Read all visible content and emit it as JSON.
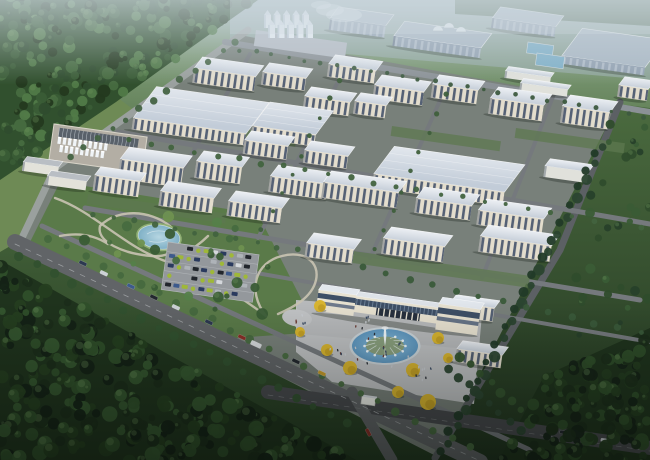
{
  "scene": {
    "kind": "aerial-architectural-rendering",
    "subject": "industrial-park-campus"
  },
  "palette": {
    "ground_top": "#a9bcbc",
    "ground_hi": "#7e9a78",
    "ground_mid": "#557548",
    "ground_low": "#3a5632",
    "ground_bot": "#243a22",
    "distant_pad": "#9fb0b6",
    "distant_roof": "#aab8c4",
    "distant_wall": "#93a2b2",
    "distant_trees": "#4e6850",
    "roof_hi": "#eef1f5",
    "roof_lo": "#c9d1db",
    "roofw_hi": "#e3e8ee",
    "roofw_lo": "#c2ccd8",
    "wall": "#e3ddcd",
    "shed_wall": "#e0e1db",
    "gray_roof": "#b9bec4",
    "gray_wall": "#e3e2da",
    "window_dark": "#46536c",
    "window_light": "#b9c4cf",
    "glass_band": "#3e4f66",
    "portal_dark": "#27303e",
    "gate_wall": "#e8e2d1",
    "campus_ground": "#78807a",
    "park_green": "#5a7a49",
    "meadow": "#6e8a55",
    "lawn_strip": "#5d7850",
    "road_light": "#9aa09e",
    "road_mid": "#75797d",
    "road_main": "#616467",
    "road_dark": "#47494d",
    "path": "#c9c3b2",
    "plaza": "#bfc1c3",
    "plaza_shade": "#b2b4b6",
    "pad_parking": "#94989c",
    "pond_hi": "#b6d6e2",
    "pond_lo": "#7fb0c6",
    "fountain_hi": "#8cc0de",
    "fountain_lo": "#5e97c0",
    "fountain_rim": "#ccd5da",
    "fountain_mound": "#8aa07e",
    "pool_blue": "#7fb0c8",
    "silo_body": "#eaf0f5",
    "silo_cone": "#dfe7ee",
    "silo_shade": "#9fb0bf",
    "tank_pad": "#b3aea4",
    "tank_frame": "#59616a",
    "tree_yellow": "#d9b52f",
    "tree_yellow_dk": "#b8941f",
    "haze": "#cfdae2"
  },
  "terrain": [
    {
      "d": "M0,0 H650 V460 H0 Z",
      "grad": "groundG"
    },
    {
      "d": "M230,0 H650 V80 L230,44 Z",
      "c": "#9fb0b6",
      "o": 0.55
    },
    {
      "d": "M455,0 H650 V26 L455,14 Z",
      "c": "#4e6850",
      "o": 0.9
    },
    {
      "d": "M0,176 L118,98 L158,128 L60,188 L24,238 L0,252 Z",
      "c": "#6e8a55",
      "o": 1
    },
    {
      "d": "M245,36 L618,104 L560,250 L436,456 L20,244 L55,168 Z",
      "c": "#78807a",
      "o": 1
    },
    {
      "d": "M618,104 L650,108 L650,460 L436,460 Z",
      "grad": "lawnG"
    },
    {
      "d": "M60,182 L258,214 L318,332 L236,338 L28,246 Z",
      "c": "#5a7a49",
      "o": 1
    },
    {
      "d": "M0,0 L258,0 L196,44 L116,102 L0,180 Z",
      "c": "#31502e",
      "o": 1
    },
    {
      "d": "M0,260 L360,462 L0,462 Z",
      "c": "#1f331d",
      "o": 1
    },
    {
      "d": "M544,376 L650,328 L650,462 L498,462 Z",
      "c": "#1f331d",
      "o": 1
    },
    {
      "d": "M296,300 L482,314 L474,404 L332,382 L296,352 Z",
      "c": "#bfc1c3",
      "o": 1
    },
    {
      "d": "M296,300 L482,314 L478,350 L300,334 Z",
      "c": "#b2b4b6",
      "o": 0.55
    }
  ],
  "roads": [
    {
      "d": "M248,30 L55,168 L20,242",
      "w": 7,
      "c": "#9aa09e"
    },
    {
      "d": "M225,42 L650,112",
      "w": 6,
      "c": "#8b9196"
    },
    {
      "d": "M620,102 L560,250 L435,458",
      "w": 7,
      "c": "#5c6064"
    },
    {
      "d": "M15,242 L480,462",
      "w": 16,
      "c": "#616467"
    },
    {
      "d": "M42,226 L530,450",
      "w": 5,
      "c": "#75797d"
    },
    {
      "d": "M118,132 L650,224",
      "w": 5,
      "c": "#75797d"
    },
    {
      "d": "M85,208 L640,300",
      "w": 5,
      "c": "#75797d"
    },
    {
      "d": "M228,268 L650,342",
      "w": 4,
      "c": "#75797d"
    },
    {
      "d": "M162,205 L250,54",
      "w": 4,
      "c": "#75797d"
    },
    {
      "d": "M258,238 L346,66",
      "w": 4,
      "c": "#75797d"
    },
    {
      "d": "M370,258 L450,78",
      "w": 4,
      "c": "#75797d"
    },
    {
      "d": "M482,278 L554,94",
      "w": 4,
      "c": "#75797d"
    },
    {
      "d": "M268,392 L650,448",
      "w": 14,
      "c": "#47494d"
    },
    {
      "d": "M352,392 L392,460",
      "w": 11,
      "c": "#606366"
    },
    {
      "d": "M15,244 L478,460",
      "w": 0.8,
      "c": "#9b9ea1",
      "dash": "5,7"
    },
    {
      "d": "M268,395 L650,451",
      "w": 0.7,
      "c": "#707376",
      "dash": "5,6"
    }
  ],
  "lawn_strips": [
    [
      148,
      116,
      150,
      10
    ],
    [
      88,
      194,
      140,
      10
    ],
    [
      332,
      248,
      200,
      12
    ],
    [
      516,
      128,
      110,
      10
    ],
    [
      392,
      126,
      110,
      10
    ]
  ],
  "park_paths": [
    "M55,198 C95,212 125,248 168,262 C205,274 240,296 266,316",
    "M100,226 C118,208 150,210 170,226 C188,240 176,258 152,256 C124,254 96,242 100,226",
    "M266,316 C246,290 256,262 282,256 C304,250 320,262 316,280 C312,298 292,308 278,314",
    "M168,262 C186,254 198,246 208,236",
    "M60,236 C80,232 96,236 108,244"
  ],
  "pond": {
    "cx": 159,
    "cy": 237,
    "rx": 21,
    "ry": 12,
    "rot": 8
  },
  "west_plaza": {
    "cx": 297,
    "cy": 318,
    "rx": 15,
    "ry": 8.5,
    "rot": 8
  },
  "parking": {
    "x": 168,
    "y": 242,
    "w": 92,
    "h": 48,
    "rot": 8,
    "rows": 5,
    "cols": 10,
    "car_colors": [
      "#2a3a5e",
      "#d4d7db",
      "#22262c",
      "#3d5a8c",
      "#9fb838",
      "#d4d7db",
      "#2a3a5e",
      "#9fb838",
      "#aeb3b8",
      "#22262c"
    ]
  },
  "distant_buildings": [
    [
      332,
      6,
      56,
      12,
      12,
      "d"
    ],
    [
      396,
      20,
      88,
      16,
      10,
      "d"
    ],
    [
      494,
      6,
      64,
      12,
      10,
      "d"
    ],
    [
      566,
      26,
      84,
      30,
      8,
      "d"
    ]
  ],
  "pools": [
    [
      528,
      42,
      26,
      11
    ],
    [
      537,
      53,
      28,
      12
    ]
  ],
  "silos": {
    "pad": [
      256,
      30,
      92,
      16
    ],
    "rows": [
      [
        264,
        10,
        5,
        9.5
      ],
      [
        268,
        20,
        5,
        9.5
      ]
    ]
  },
  "domes": [
    [
      438,
      31
    ],
    [
      449,
      28
    ],
    [
      461,
      32
    ]
  ],
  "steam": [
    [
      330,
      10,
      14,
      6
    ],
    [
      344,
      15,
      18,
      7
    ],
    [
      321,
      5,
      10,
      4
    ]
  ],
  "tank_farm": {
    "pad": [
      54,
      124,
      94,
      36
    ],
    "frame": [
      60,
      127,
      80,
      9
    ],
    "rows": [
      [
        60,
        136,
        10,
        5.2
      ],
      [
        63,
        144,
        9,
        5.2
      ]
    ],
    "sheds": [
      [
        24,
        156,
        36,
        6,
        9,
        "g"
      ],
      [
        48,
        170,
        40,
        6,
        9,
        "g"
      ]
    ]
  },
  "campus_buildings": [
    [
      196,
      56,
      62,
      12,
      15,
      "f"
    ],
    [
      264,
      62,
      44,
      10,
      13,
      "f"
    ],
    [
      330,
      54,
      48,
      10,
      13,
      "f"
    ],
    [
      376,
      74,
      50,
      11,
      14,
      "f"
    ],
    [
      434,
      74,
      46,
      10,
      14,
      "f"
    ],
    [
      492,
      86,
      54,
      12,
      16,
      "f"
    ],
    [
      564,
      94,
      48,
      12,
      17,
      "f"
    ],
    [
      620,
      76,
      30,
      9,
      12,
      "f"
    ],
    [
      506,
      66,
      46,
      5,
      7,
      "s"
    ],
    [
      521,
      78,
      48,
      5,
      7,
      "s"
    ],
    [
      138,
      84,
      114,
      34,
      12,
      "w"
    ],
    [
      256,
      100,
      64,
      26,
      12,
      "w"
    ],
    [
      306,
      86,
      46,
      10,
      14,
      "f"
    ],
    [
      356,
      92,
      32,
      9,
      13,
      "f"
    ],
    [
      378,
      144,
      132,
      30,
      14,
      "w"
    ],
    [
      546,
      158,
      44,
      8,
      11,
      "s"
    ],
    [
      96,
      166,
      46,
      9,
      16,
      "f"
    ],
    [
      122,
      146,
      64,
      13,
      20,
      "f"
    ],
    [
      198,
      150,
      46,
      11,
      17,
      "f"
    ],
    [
      246,
      130,
      44,
      10,
      14,
      "f"
    ],
    [
      272,
      164,
      58,
      12,
      16,
      "f"
    ],
    [
      306,
      140,
      44,
      10,
      13,
      "f"
    ],
    [
      325,
      170,
      76,
      12,
      16,
      "f"
    ],
    [
      418,
      186,
      56,
      12,
      15,
      "f"
    ],
    [
      480,
      198,
      66,
      12,
      15,
      "f"
    ],
    [
      162,
      180,
      54,
      11,
      15,
      "f"
    ],
    [
      230,
      190,
      54,
      11,
      15,
      "f"
    ],
    [
      308,
      232,
      48,
      11,
      14,
      "f"
    ],
    [
      385,
      226,
      62,
      12,
      16,
      "f"
    ],
    [
      482,
      224,
      72,
      12,
      16,
      "f"
    ],
    [
      452,
      294,
      44,
      8,
      14,
      "f"
    ],
    [
      458,
      340,
      46,
      9,
      13,
      "f"
    ]
  ],
  "gate": {
    "x": 320,
    "y": 280
  },
  "fountain": {
    "cx": 385,
    "cy": 346,
    "rx": 33,
    "ry": 17,
    "jets": 12
  },
  "booth": {
    "x": 362,
    "y": 396,
    "w": 14,
    "h": 8
  },
  "yellow_trees": [
    [
      320,
      306,
      6
    ],
    [
      327,
      350,
      6
    ],
    [
      350,
      368,
      7
    ],
    [
      413,
      370,
      7
    ],
    [
      428,
      402,
      8
    ],
    [
      438,
      338,
      6
    ],
    [
      398,
      392,
      6
    ],
    [
      448,
      358,
      5
    ],
    [
      300,
      332,
      5
    ]
  ],
  "hedges": [
    [
      240,
      50,
      645,
      116,
      26,
      2,
      "#3d5a3f"
    ],
    [
      236,
      42,
      70,
      158,
      13,
      3,
      "#446343"
    ],
    [
      48,
      238,
      470,
      448,
      24,
      3.5,
      "#47693f"
    ],
    [
      20,
      256,
      348,
      424,
      20,
      4,
      "#32512f"
    ],
    [
      604,
      146,
      448,
      444,
      18,
      4.5,
      "#2b4530"
    ],
    [
      596,
      152,
      440,
      450,
      18,
      4,
      "#223a28"
    ],
    [
      128,
      140,
      640,
      228,
      24,
      2.5,
      "#42633f"
    ],
    [
      94,
      214,
      298,
      250,
      11,
      2.5,
      "#42633f"
    ],
    [
      364,
      268,
      640,
      334,
      13,
      3,
      "#3a5a3a"
    ],
    [
      262,
      230,
      340,
      80,
      9,
      2.2,
      "#3f5f3c"
    ],
    [
      376,
      250,
      446,
      94,
      9,
      2.2,
      "#3f5f3c"
    ],
    [
      448,
      368,
      520,
      430,
      8,
      4,
      "#2c4631"
    ],
    [
      460,
      356,
      532,
      420,
      8,
      4,
      "#35542f"
    ]
  ],
  "forests": [
    {
      "poly": [
        [
          0,
          -6
        ],
        [
          260,
          -6
        ],
        [
          196,
          44
        ],
        [
          116,
          102
        ],
        [
          0,
          180
        ]
      ],
      "n": 240,
      "rmin": 2.5,
      "rmax": 6.5,
      "colors": [
        "#2f4c2e",
        "#3a5c36",
        "#476c40",
        "#24391f",
        "#517a48"
      ],
      "seed": 11,
      "late": false
    },
    {
      "poly": [
        [
          50,
          195
        ],
        [
          250,
          220
        ],
        [
          300,
          300
        ],
        [
          250,
          330
        ],
        [
          60,
          260
        ]
      ],
      "n": 26,
      "rmin": 2.5,
      "rmax": 6,
      "colors": [
        "#3a5c36",
        "#476c40",
        "#55804a",
        "#6f9150"
      ],
      "seed": 55,
      "late": false
    },
    {
      "poly": [
        [
          0,
          262
        ],
        [
          360,
          462
        ],
        [
          0,
          462
        ]
      ],
      "n": 280,
      "rmin": 3,
      "rmax": 8,
      "colors": [
        "#1b2d1a",
        "#253e20",
        "#2f4f2a",
        "#142216",
        "#35562f"
      ],
      "seed": 22,
      "late": true
    },
    {
      "poly": [
        [
          544,
          376
        ],
        [
          650,
          328
        ],
        [
          650,
          462
        ],
        [
          498,
          462
        ]
      ],
      "n": 140,
      "rmin": 3,
      "rmax": 7,
      "colors": [
        "#1b2d1a",
        "#243c20",
        "#2e4d29",
        "#152317"
      ],
      "seed": 33,
      "late": true
    },
    {
      "poly": [
        [
          614,
          108
        ],
        [
          650,
          112
        ],
        [
          650,
          330
        ],
        [
          566,
          336
        ],
        [
          592,
          180
        ]
      ],
      "n": 30,
      "rmin": 2.5,
      "rmax": 5.5,
      "colors": [
        "#2f4c2c",
        "#27402a",
        "#3a5c36"
      ],
      "seed": 44,
      "late": true
    }
  ],
  "people_clusters": [
    [
      385,
      348,
      34,
      14
    ],
    [
      362,
      320,
      13,
      6
    ],
    [
      299,
      320,
      11,
      6
    ],
    [
      422,
      370,
      16,
      7
    ],
    [
      336,
      352,
      10,
      5
    ]
  ],
  "people_colors": [
    "#2b2f36",
    "#6b3a33",
    "#c9cdd2",
    "#3a4a63"
  ],
  "cars": [
    [
      80,
      260,
      "#2c3850",
      25,
      0
    ],
    [
      101,
      270,
      "#ccd1d6",
      25,
      0
    ],
    [
      128,
      283,
      "#3d5a8c",
      25,
      0
    ],
    [
      151,
      294,
      "#23282e",
      25,
      0
    ],
    [
      173,
      304,
      "#ccd1d6",
      25,
      0
    ],
    [
      206,
      319,
      "#2c3850",
      25,
      0
    ],
    [
      239,
      334,
      "#8a2f28",
      25,
      0
    ],
    [
      252,
      340,
      "#d8dbde",
      25,
      1
    ],
    [
      293,
      358,
      "#23282e",
      25,
      0
    ],
    [
      319,
      370,
      "#c59a2a",
      25,
      0
    ],
    [
      560,
      430,
      "#23282e",
      8,
      0
    ],
    [
      601,
      438,
      "#ccd1d6",
      8,
      0
    ],
    [
      368,
      428,
      "#8a2f28",
      62,
      0
    ]
  ]
}
